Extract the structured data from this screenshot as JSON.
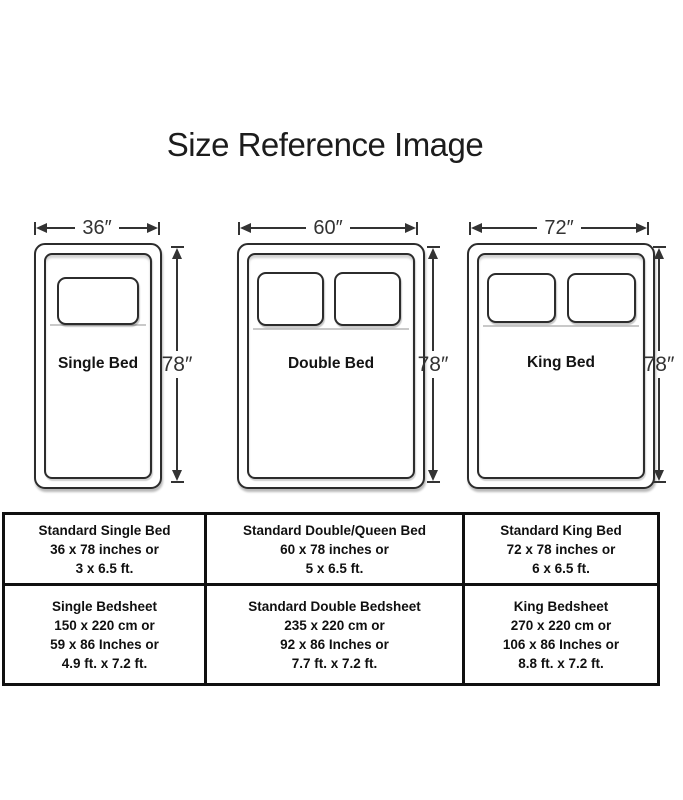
{
  "title": "Size Reference Image",
  "beds": [
    {
      "id": "single",
      "label": "Single Bed",
      "width_label": "36″",
      "height_label": "78″",
      "pillow_count": 1
    },
    {
      "id": "double",
      "label": "Double Bed",
      "width_label": "60″",
      "height_label": "78″",
      "pillow_count": 2
    },
    {
      "id": "king",
      "label": "King Bed",
      "width_label": "72″",
      "height_label": "78″",
      "pillow_count": 2
    }
  ],
  "table": {
    "rows": [
      {
        "cells": [
          {
            "lines": [
              "Standard Single Bed",
              "36 x 78 inches or",
              "3 x 6.5 ft."
            ]
          },
          {
            "lines": [
              "Standard Double/Queen Bed",
              "60 x 78 inches or",
              "5 x 6.5 ft."
            ]
          },
          {
            "lines": [
              "Standard King Bed",
              "72 x 78 inches or",
              "6 x 6.5 ft."
            ]
          }
        ]
      },
      {
        "cells": [
          {
            "lines": [
              "Single Bedsheet",
              "150 x 220 cm or",
              "59 x 86 Inches or",
              "4.9 ft. x 7.2 ft."
            ]
          },
          {
            "lines": [
              "Standard Double Bedsheet",
              "235 x 220 cm or",
              "92 x 86 Inches or",
              "7.7 ft. x 7.2 ft."
            ]
          },
          {
            "lines": [
              "King Bedsheet",
              "270 x 220 cm or",
              "106 x 86 Inches or",
              "8.8 ft. x 7.2 ft."
            ]
          }
        ]
      }
    ]
  },
  "colors": {
    "ink": "#333333",
    "bed_outline": "#2c2c2c",
    "table_border": "#101010",
    "background": "#ffffff"
  }
}
